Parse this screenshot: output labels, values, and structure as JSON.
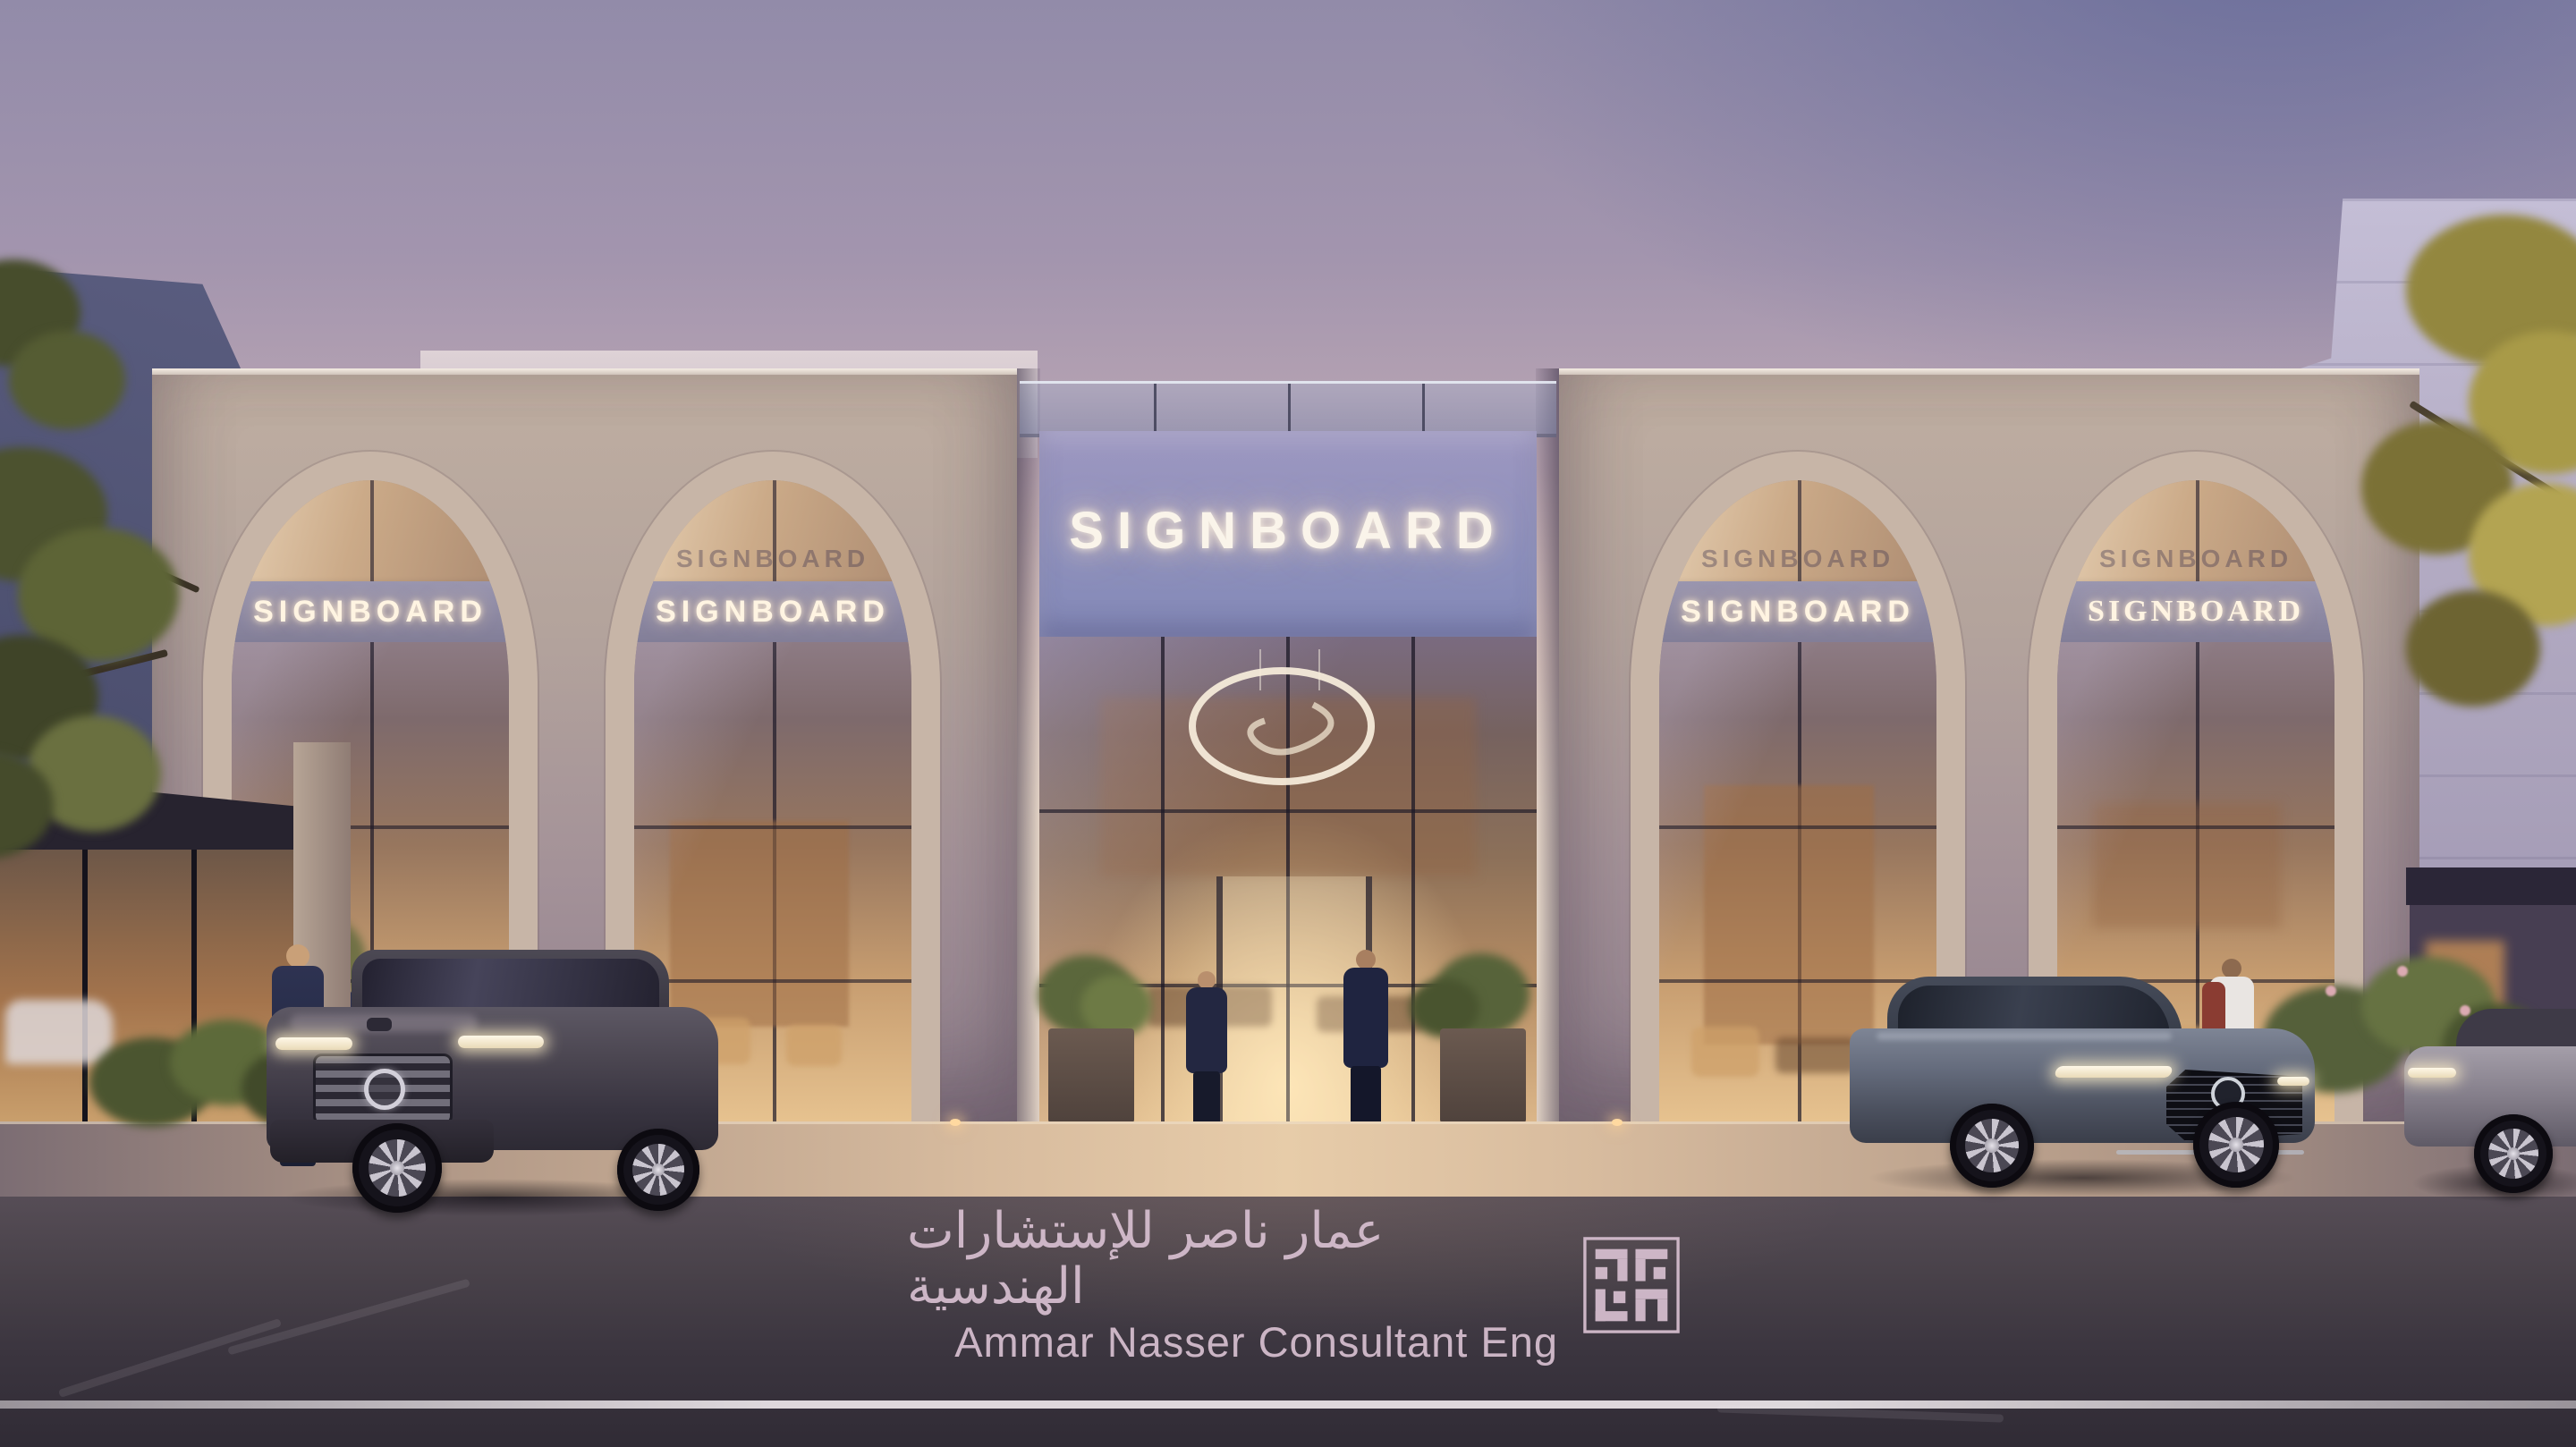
{
  "scene": {
    "description": "Dusk architectural rendering of a commercial showroom facade with four arched glass bays, illuminated signboards, central glass entrance with ring chandelier, parked cars and pedestrians",
    "time_of_day": "dusk"
  },
  "signage": {
    "main_text": "SIGNBOARD",
    "arch_signs": [
      "SIGNBOARD",
      "SIGNBOARD",
      "SIGNBOARD",
      "SIGNBOARD"
    ]
  },
  "watermark": {
    "arabic_line": "عمار ناصر للإستشارات الهندسية",
    "english_line": "Ammar Nasser Consultant Eng",
    "logo": "square-kufic-monogram"
  },
  "colors": {
    "sky_top": "#928ba9",
    "sky_horizon": "#f6e9da",
    "stone": "#b3a39c",
    "sign_panel": "#8d90bd",
    "arch_band": "#8a86a0",
    "sign_glow": "#fff4e2",
    "interior_glow": "#dcb78a",
    "street": "#3b353f",
    "watermark": "#d8c0d1"
  }
}
